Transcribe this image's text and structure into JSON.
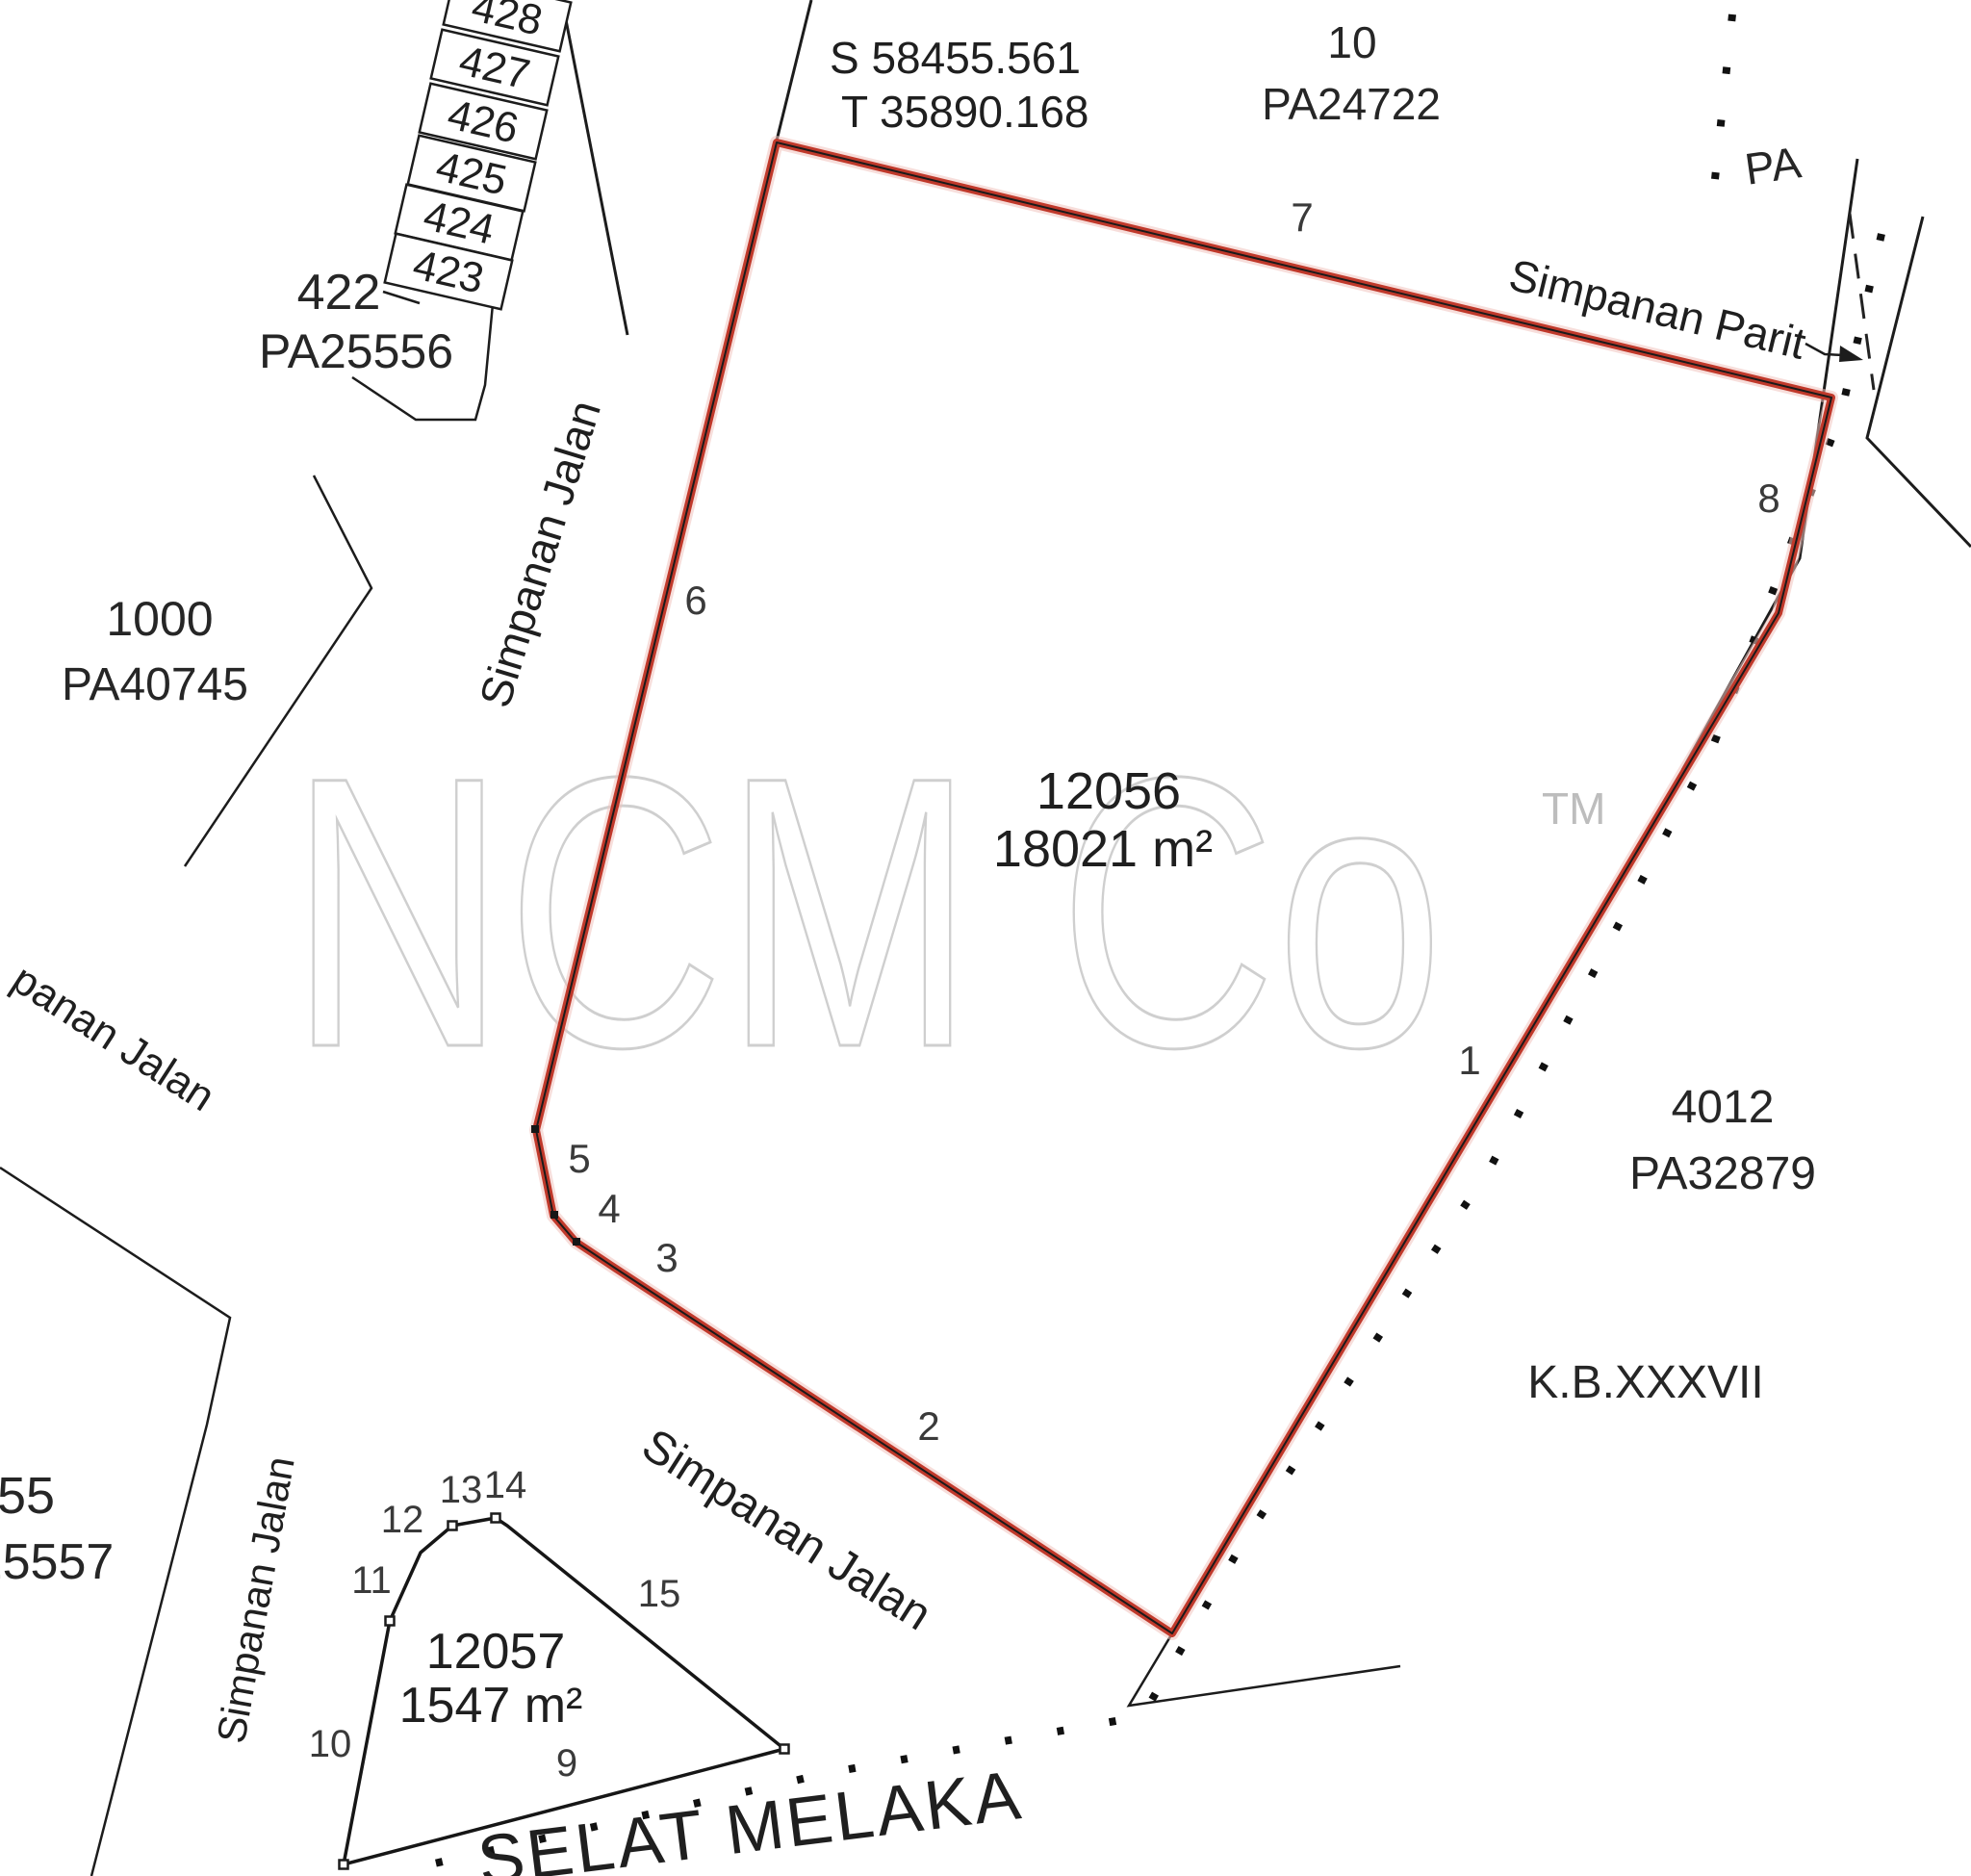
{
  "map": {
    "watermark": {
      "name": "NCM Co",
      "tm": "TM"
    },
    "colors": {
      "highlight_red": "#c0392b",
      "halo_pink": "#f0c3bd",
      "paper": "#ffffff",
      "ink": "#1f1f1f",
      "watermark_gray": "#cfcfcf"
    },
    "coordinates": {
      "s": "S 58455.561",
      "t": "T 35890.168"
    },
    "main_lot": {
      "number": "12056",
      "area": "18021 m²",
      "vertex_labels": [
        "1",
        "2",
        "3",
        "4",
        "5",
        "6",
        "7",
        "8"
      ]
    },
    "small_lot": {
      "number": "12057",
      "area": "1547 m²",
      "vertex_labels": [
        "9",
        "10",
        "11",
        "12",
        "13",
        "14",
        "15"
      ]
    },
    "neighbors": {
      "north": {
        "number": "10",
        "grant": "PA24722"
      },
      "west_stack": [
        "428",
        "427",
        "426",
        "425",
        "424",
        "423"
      ],
      "lot422": {
        "number": "422",
        "grant": "PA25556"
      },
      "lot1000": {
        "number": "1000",
        "grant": "PA40745"
      },
      "east": {
        "number": "4012",
        "grant": "PA32879"
      },
      "southwest": {
        "number": "55",
        "grant": "25557"
      },
      "east_partial": "PA"
    },
    "roads": {
      "left": "Simpanan Jalan",
      "bottom": "Simpanan Jalan",
      "lower_left_vertical": "Simpanan Jalan",
      "upper_left_partial": "panan Jalan"
    },
    "drain": "Simpanan Parit",
    "section": "K.B.XXXVII",
    "sea": "SELAT MELAKA"
  }
}
